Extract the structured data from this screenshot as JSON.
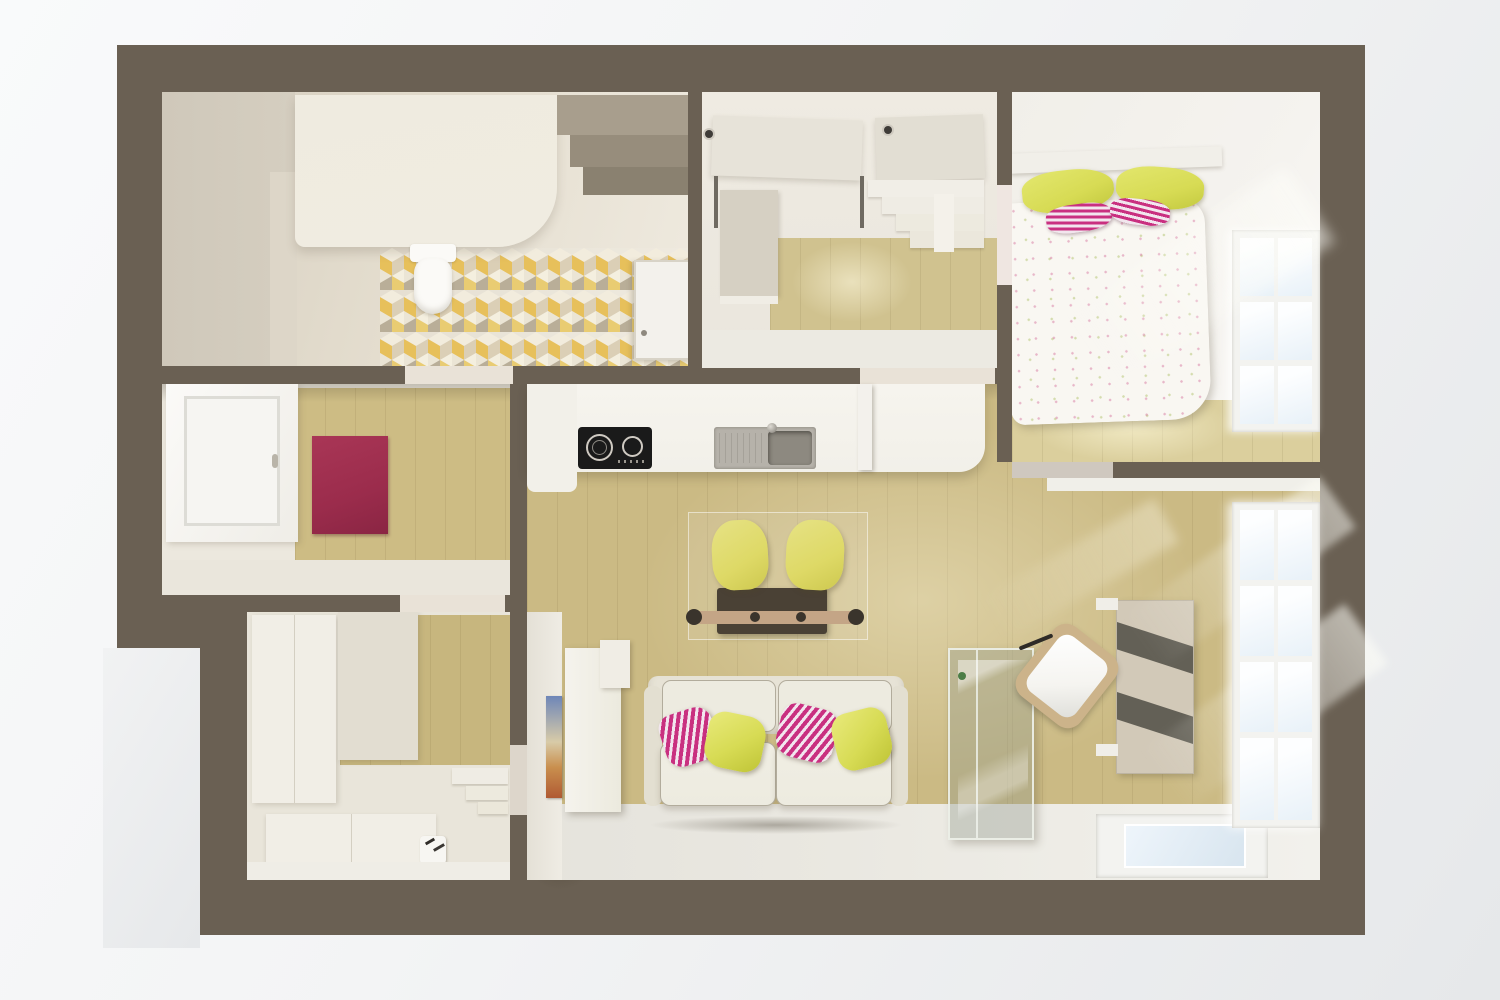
{
  "scene": {
    "type": "3d-top-down-floor-plan-render",
    "rooms": [
      "bathroom",
      "entry-hall",
      "bedroom",
      "window-room",
      "storage-room",
      "kitchen",
      "living-dining-room",
      "balcony-strip"
    ],
    "furniture": [
      "vanity-unit",
      "wall-hung-toilet",
      "bathroom-shelves",
      "bathroom-door",
      "hall-wardrobe",
      "open-door-leaves",
      "shoe-steps",
      "double-bed",
      "bed-pillows",
      "bedroom-window",
      "left-window",
      "red-rug",
      "wardrobes",
      "sideboard",
      "radiator",
      "corner-steps",
      "kitchen-counter",
      "cooktop",
      "sink",
      "dining-table",
      "yellow-chairs",
      "two-seat-sofa",
      "sofa-pillows",
      "glass-display-cabinet",
      "desk",
      "office-chair",
      "wall-art",
      "living-window",
      "floor-window"
    ]
  },
  "colors": {
    "bg-outer-light": "#f9fafb",
    "bg-outer-dark": "#e6e8ea",
    "wall": "#6a6053",
    "bath-base": "#e2dbcc",
    "bath-left-wall": "#d5cec0",
    "vanity": "#f0ece1",
    "shelf1": "#a89e8d",
    "shelf2": "#978d7c",
    "shelf3": "#8a8170",
    "tile-yellow": "#e5bb4e",
    "tile-yellow2": "#e8c867",
    "tile-light": "#f1ebdb",
    "tile-gray": "#b3a890",
    "tile-tan": "#d8cbb0",
    "toilet": "#fbfaf7",
    "door": "#f3f1ec",
    "door-frame": "#d8d3c7",
    "hall-base": "#eae6dd",
    "hall-floor": "#d0c28f",
    "wardrobe": "#d6d0c3",
    "slab": "#e7e3d9",
    "hinge": "#3f3c38",
    "bedroom-base": "#f5f3ef",
    "bedroom-floor": "#dbcf9d",
    "headboard": "#f1efe9",
    "duvet": "#f9f7f2",
    "pillow-yellow": "#d7db54",
    "pillow-pink": "#c93080",
    "pillow-pink-light": "#f2e6ee",
    "window-frame": "#f3f3f0",
    "window-pane": "#fdfeff",
    "window-pane-blue": "#e8f1f8",
    "window-mullion": "#dddcd6",
    "midroom-base": "#ece8de",
    "midroom-floor": "#cdbc84",
    "rug": "#9b2c4c",
    "storage-base": "#e9e5da",
    "storage-floor": "#c7b67e",
    "cabinet-white": "#f1eee6",
    "cabinet-gray": "#e2ddd1",
    "living-floor": "#cbba84",
    "floor-white": "#eae8e1",
    "counter": "#f2f0e9",
    "cooktop": "#1a1a1a",
    "burner-ring": "#cfcac2",
    "sink-steel": "#b6b2aa",
    "sink-basin": "#8d8980",
    "table-dark": "#4a4135",
    "table-wood": "#c4a586",
    "knob-dark": "#3a342c",
    "chair-yellow": "#ded966",
    "sofa-base": "#e7e3d6",
    "sofa-cushion": "#edebe0",
    "sofa-piping": "#b2ac9c",
    "glass-fill": "rgba(146,156,141,0.38)",
    "glass-edge": "rgba(238,242,234,0.9)",
    "glass-speck": "#4c7d46",
    "desk": "#d2c9b8",
    "desk-stripe": "rgba(62,60,53,0.75)",
    "chair-wood": "#ccb38a",
    "chair-seat": "#f5f4f0",
    "art-blue": "#6e86b8",
    "art-orange": "#c98f4e",
    "art-rust": "#b05a33",
    "skylight-pane": "#d8e5ef",
    "radiator": "#f7f6f2",
    "sill": "#e9e2d7",
    "sill-dark": "#cfc8bf",
    "door-gap": "#efe6e1"
  }
}
